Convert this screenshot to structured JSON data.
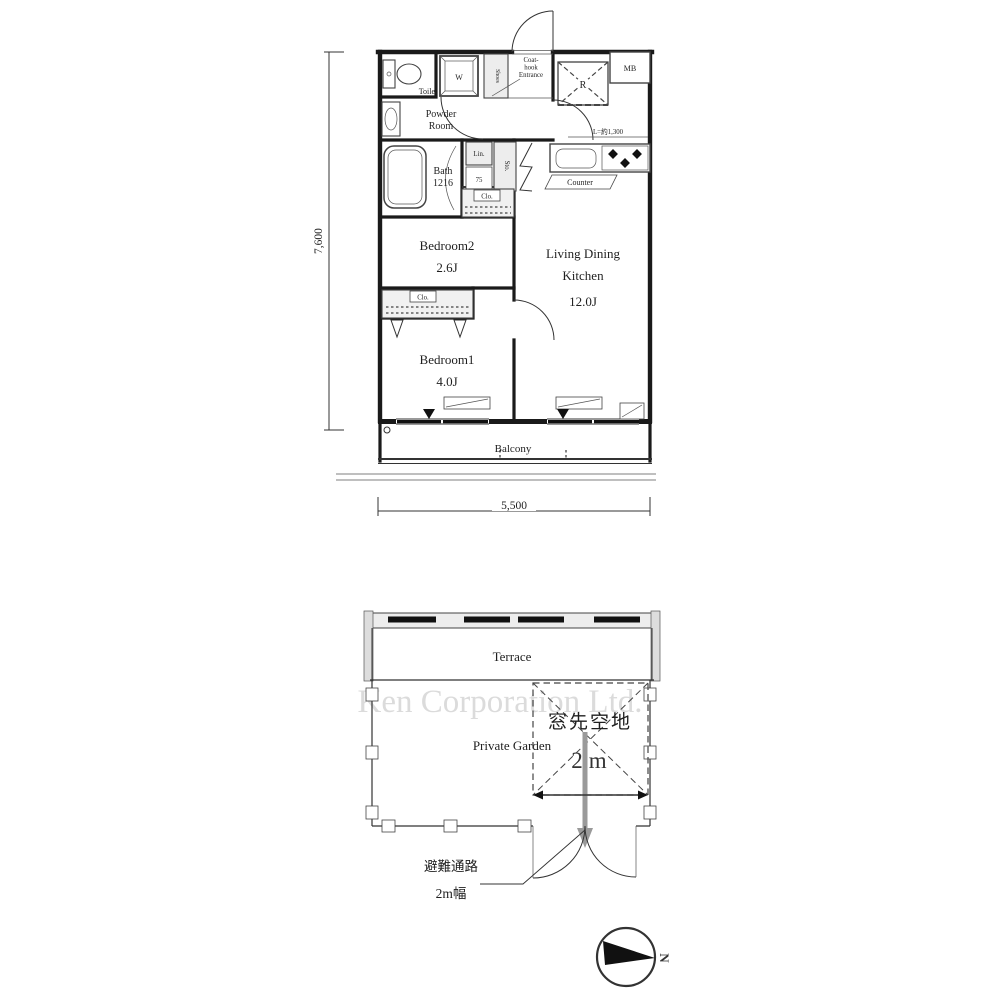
{
  "watermark": "Ken Corporation Ltd.",
  "upper_plan": {
    "dimensions": {
      "height": "7,600",
      "width": "5,500"
    },
    "rooms": {
      "toilet": "Toilet",
      "powder_line1": "Powder",
      "powder_line2": "Room",
      "bath": "Bath",
      "bath_size": "1216",
      "bedroom2": "Bedroom2",
      "bedroom2_size": "2.6J",
      "bedroom1": "Bedroom1",
      "bedroom1_size": "4.0J",
      "ldk_line1": "Living Dining",
      "ldk_line2": "Kitchen",
      "ldk_size": "12.0J",
      "balcony": "Balcony"
    },
    "labels": {
      "entrance_line1": "Coat-",
      "entrance_line2": "hook",
      "entrance_line3": "Entrance",
      "washer": "W",
      "shoes": "Shoes",
      "refrigerator": "R",
      "meter_box": "MB",
      "linen": "Lin.",
      "linen_width": "75",
      "storage": "Sto.",
      "closet": "Clo.",
      "counter": "Counter",
      "counter_length": "L=約1,300"
    }
  },
  "lower_plan": {
    "terrace": "Terrace",
    "private_garden": "Private Garden",
    "open_space": "窓先空地",
    "open_space_width": "2m",
    "evacuation_line1": "避難通路",
    "evacuation_line2": "2m幅"
  },
  "compass": {
    "north": "N"
  }
}
